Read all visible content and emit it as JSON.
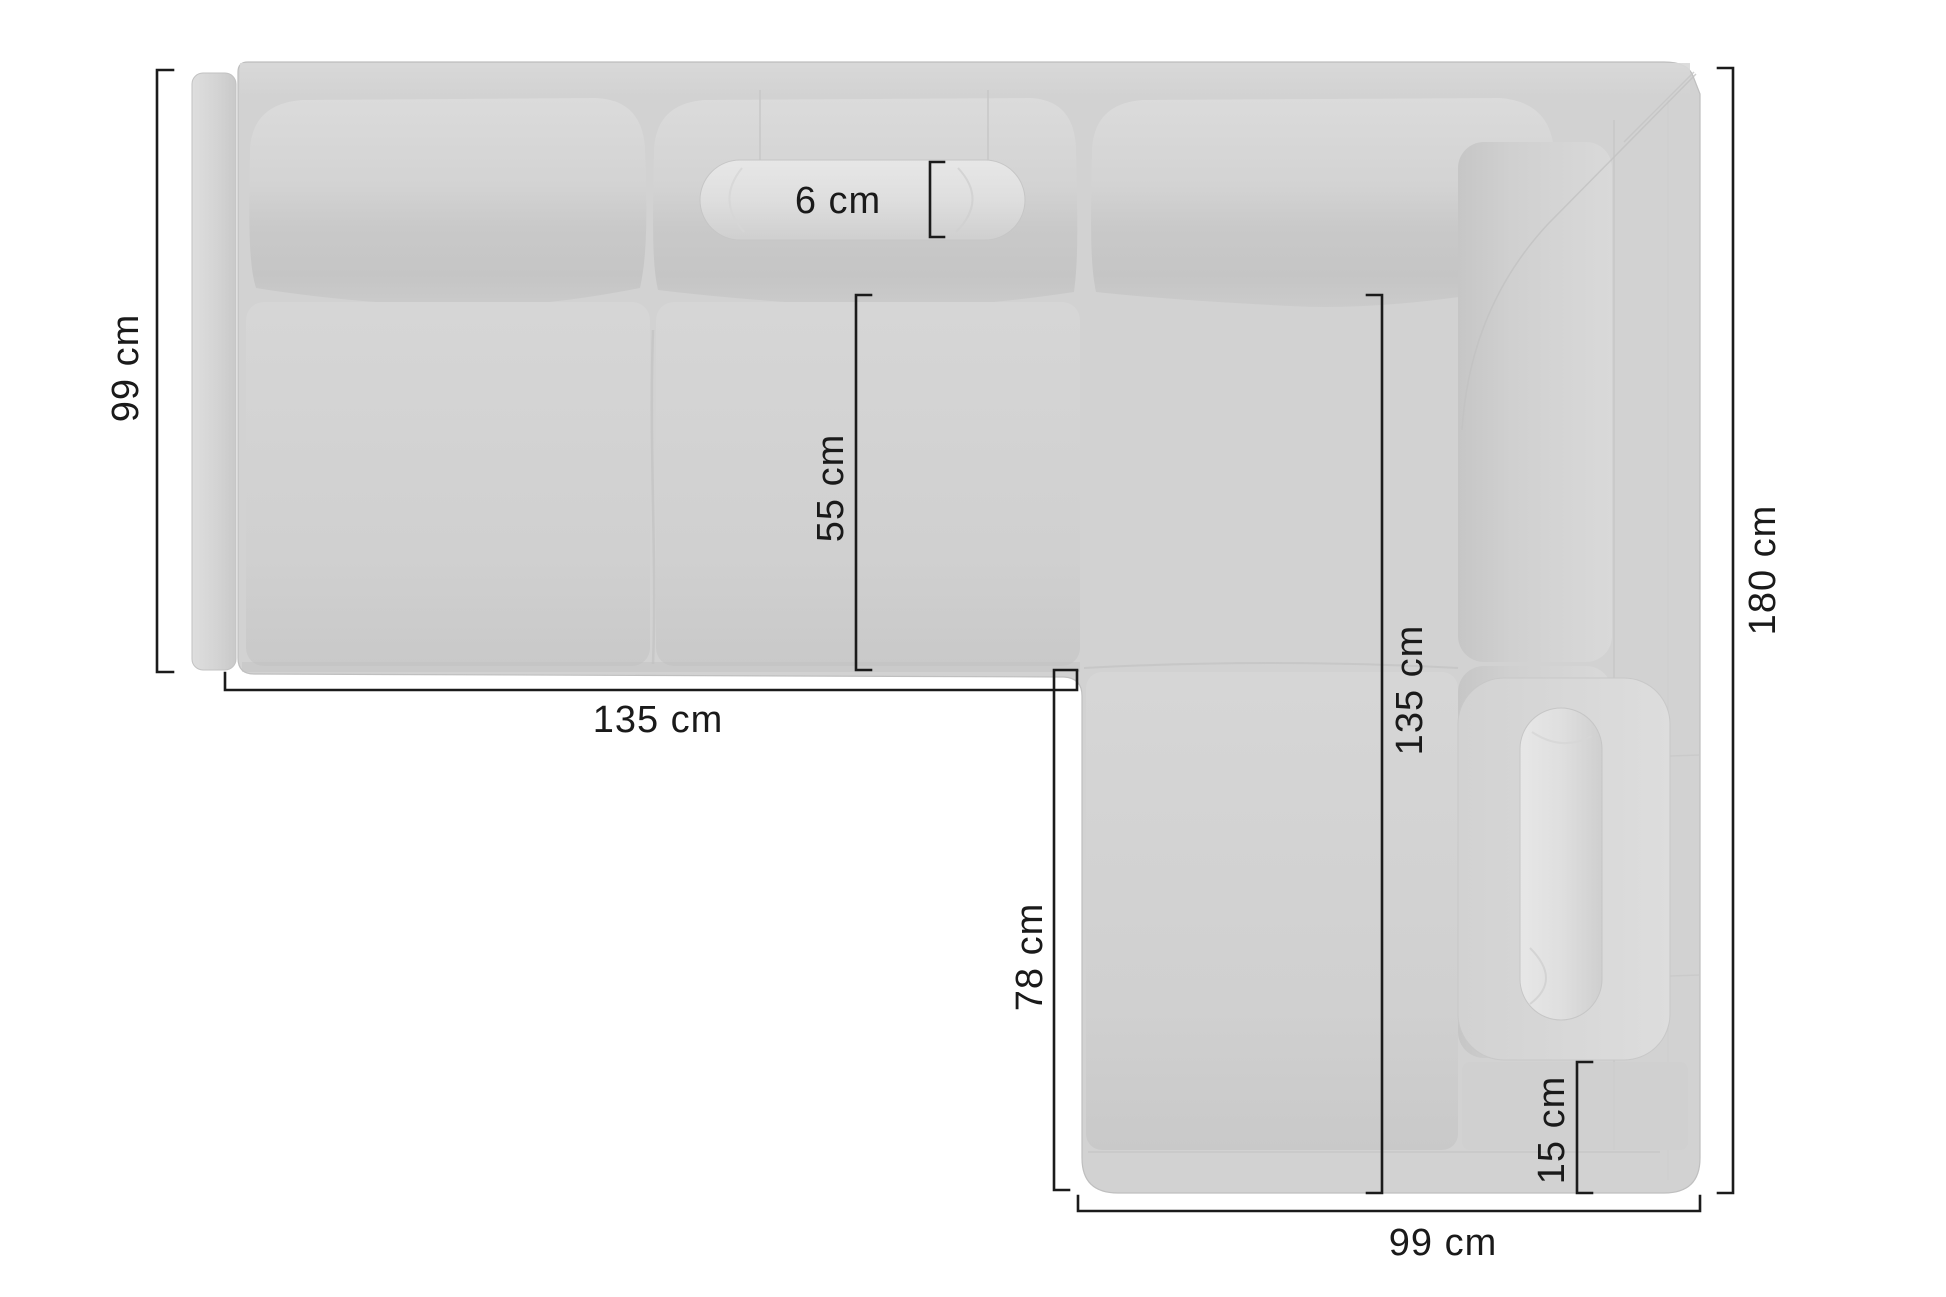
{
  "diagram": {
    "kind": "corner-sofa-top-view-dimension-diagram",
    "unit": "cm",
    "dims": {
      "left_section_depth": {
        "label": "99 cm",
        "value": 99,
        "orientation": "vertical-left"
      },
      "bolster_thickness": {
        "label": "6 cm",
        "value": 6,
        "orientation": "bracket-top"
      },
      "seat_depth": {
        "label": "55 cm",
        "value": 55,
        "orientation": "vertical-inner"
      },
      "left_section_width": {
        "label": "135 cm",
        "value": 135,
        "orientation": "horizontal-bottom-left"
      },
      "right_section_inner": {
        "label": "135 cm",
        "value": 135,
        "orientation": "vertical-inner-right"
      },
      "chaise_inner_length": {
        "label": "78 cm",
        "value": 78,
        "orientation": "vertical-inner-left"
      },
      "right_section_length": {
        "label": "180 cm",
        "value": 180,
        "orientation": "vertical-right"
      },
      "front_band_height": {
        "label": "15 cm",
        "value": 15,
        "orientation": "bracket-bottom-right"
      },
      "chaise_width": {
        "label": "99 cm",
        "value": 99,
        "orientation": "horizontal-bottom-right"
      }
    },
    "colors": {
      "background": "#ffffff",
      "sofa_base": "#d2d2d2",
      "cushion_light": "#dcdcdc",
      "cushion_dark": "#c5c5c5",
      "bolster_light": "#e6e6e6",
      "seam": "#c2c2c2",
      "dimension_line": "#1b1b1b"
    }
  }
}
